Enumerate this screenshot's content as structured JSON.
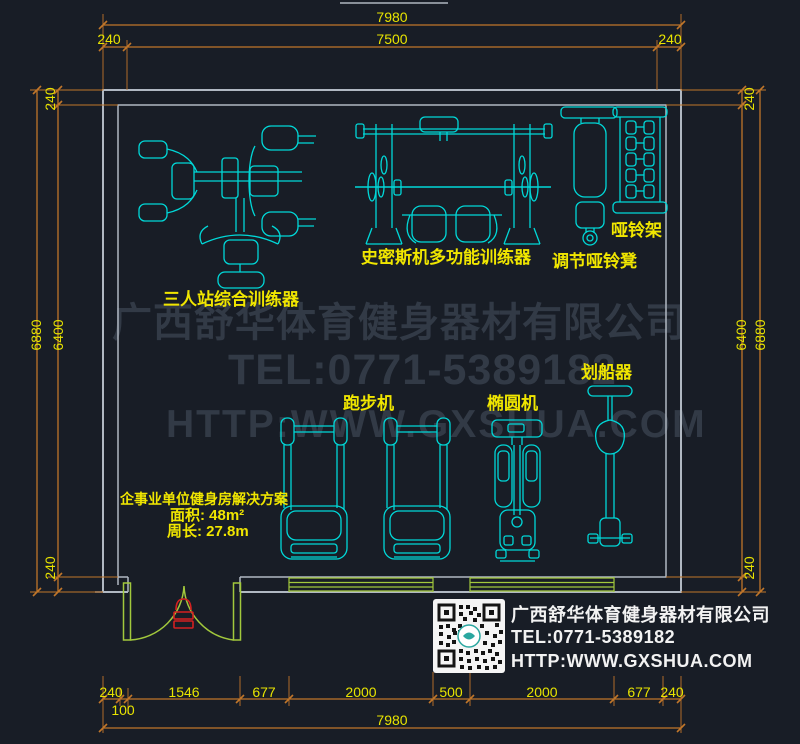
{
  "drawing": {
    "type": "gym-floor-plan",
    "room": {
      "area_label": "面积: 48m²",
      "perimeter_label": "周长: 27.8m",
      "title": "企事业单位健身房解决方案"
    }
  },
  "dims": {
    "top_overall": "7980",
    "top_inner": "7500",
    "top_left_offset": "240",
    "top_right_offset": "240",
    "left_outer": "6880",
    "left_inner": "6400",
    "left_top_offset": "240",
    "left_bottom_offset": "240",
    "right_inner": "6400",
    "right_outer": "6880",
    "right_top_offset": "240",
    "right_bottom_offset": "240",
    "bottom_segments": [
      "240",
      "1546",
      "677",
      "2000",
      "500",
      "2000",
      "677",
      "240"
    ],
    "bottom_offset_small": "100",
    "bottom_overall": "7980"
  },
  "equipment": {
    "multi_station": "三人站综合训练器",
    "smith": "史密斯机多功能训练器",
    "dumbbell_rack": "哑铃架",
    "dumbbell_bench": "调节哑铃凳",
    "treadmill": "跑步机",
    "elliptical": "椭圆机",
    "rower": "划船器"
  },
  "watermark": {
    "company": "广西舒华体育健身器材有限公司",
    "tel": "TEL:0771-5389182",
    "site": "HTTP:WWW.GXSHUA.COM"
  },
  "company_card": {
    "company": "广西舒华体育健身器材有限公司",
    "tel": "TEL:0771-5389182",
    "site": "HTTP:WWW.GXSHUA.COM"
  },
  "colors": {
    "background": "#181d26",
    "equipment_line": "#00d8d8",
    "dimension_line": "#c0762a",
    "dimension_text": "#e8e400",
    "label_text": "#f0e600",
    "wall": "#b0b8c2",
    "door_window": "#a2c83c",
    "door_symbol": "#d42020",
    "watermark": "#323a46",
    "card_text": "#f2f2f2"
  }
}
